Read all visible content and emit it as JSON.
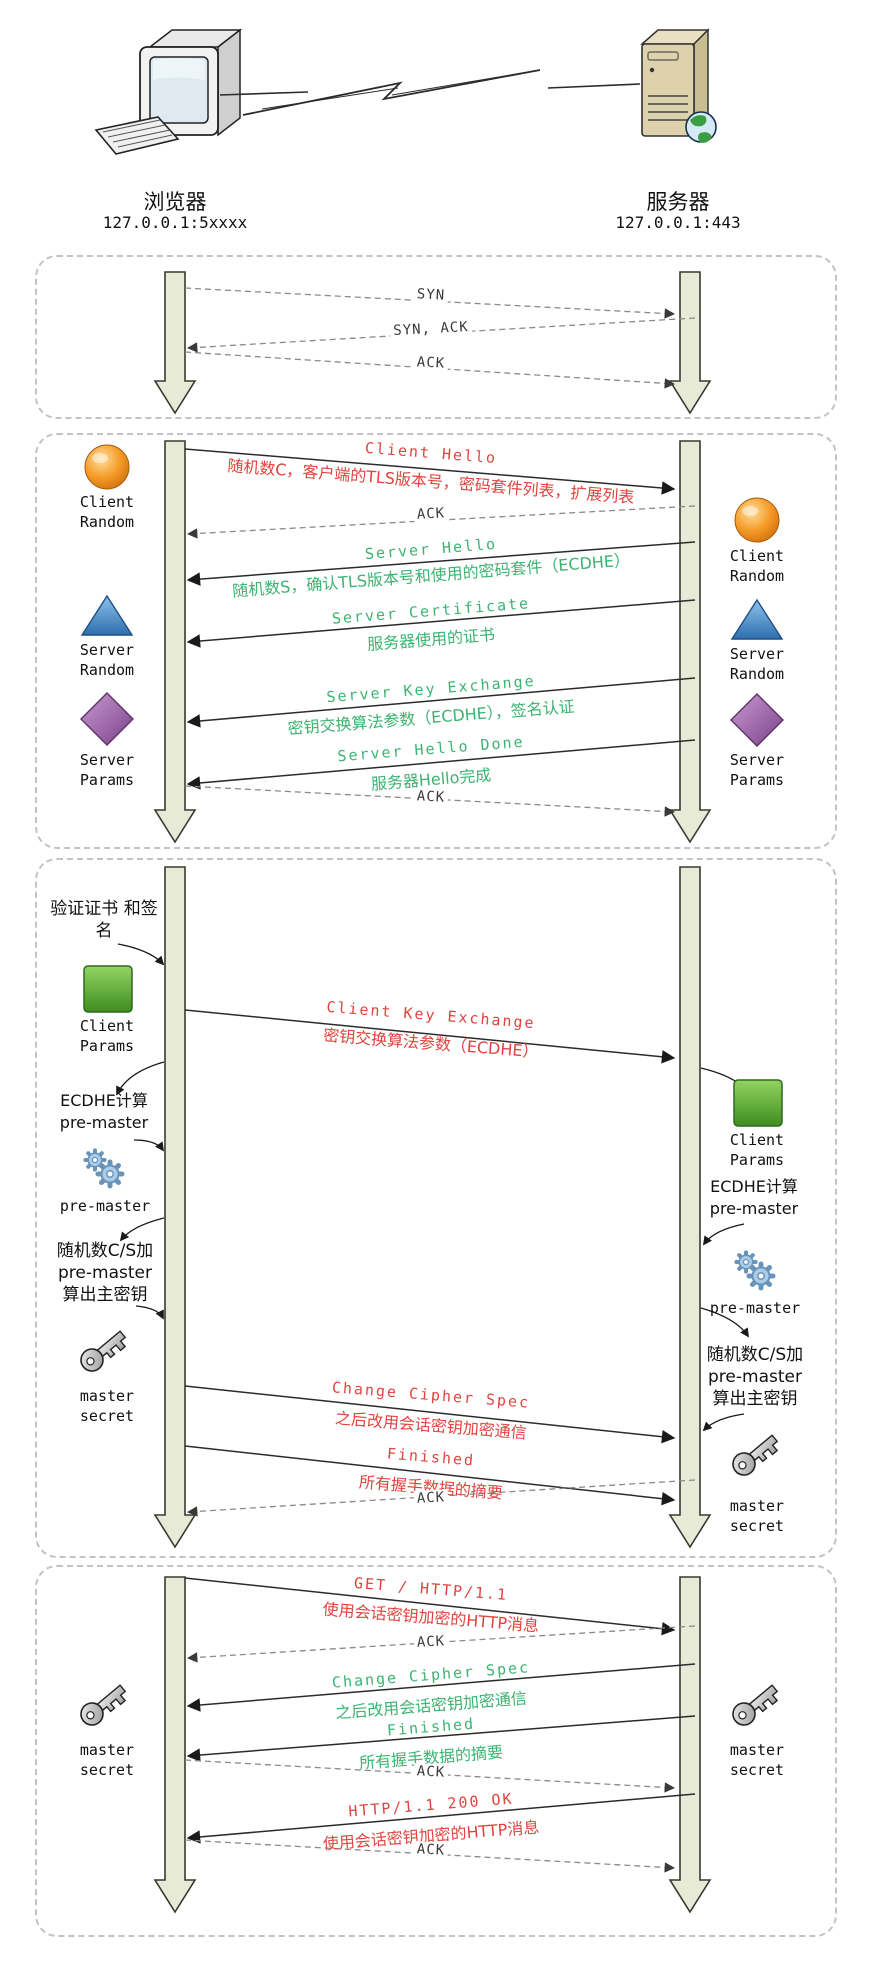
{
  "colors": {
    "message_red": "#e0443e",
    "message_green": "#3cb371",
    "lifeline_fill": "#e7ead6",
    "lifeline_border": "#3a3a30",
    "box_border": "#c3c3c3"
  },
  "endpoints": {
    "client": {
      "name": "浏览器",
      "address": "127.0.0.1:5xxxx",
      "icon": "computer-icon"
    },
    "server": {
      "name": "服务器",
      "address": "127.0.0.1:443",
      "icon": "server-icon"
    }
  },
  "phases": [
    {
      "id": "tcp-handshake",
      "messages": [
        {
          "title": "SYN",
          "direction": "right",
          "style": "dashed",
          "color": "black"
        },
        {
          "title": "SYN, ACK",
          "direction": "left",
          "style": "dashed",
          "color": "black"
        },
        {
          "title": "ACK",
          "direction": "right",
          "style": "dashed",
          "color": "black"
        }
      ]
    },
    {
      "id": "tls-hello",
      "messages": [
        {
          "title": "Client Hello",
          "subtitle": "随机数C，客户端的TLS版本号，密码套件列表，扩展列表",
          "direction": "right",
          "style": "solid",
          "color": "red"
        },
        {
          "title": "ACK",
          "direction": "left",
          "style": "dashed",
          "color": "black"
        },
        {
          "title": "Server Hello",
          "subtitle": "随机数S，确认TLS版本号和使用的密码套件（ECDHE）",
          "direction": "left",
          "style": "solid",
          "color": "green"
        },
        {
          "title": "Server Certificate",
          "subtitle": "服务器使用的证书",
          "direction": "left",
          "style": "solid",
          "color": "green"
        },
        {
          "title": "Server Key Exchange",
          "subtitle": "密钥交换算法参数（ECDHE），签名认证",
          "direction": "left",
          "style": "solid",
          "color": "green"
        },
        {
          "title": "Server Hello Done",
          "subtitle": "服务器Hello完成",
          "direction": "left",
          "style": "solid",
          "color": "green"
        },
        {
          "title": "ACK",
          "direction": "right",
          "style": "dashed",
          "color": "black"
        }
      ],
      "client_column": [
        {
          "icon": "sphere-icon",
          "label": "Client Random"
        },
        {
          "icon": "triangle-icon",
          "label": "Server Random"
        },
        {
          "icon": "diamond-icon",
          "label": "Server Params"
        }
      ],
      "server_column": [
        {
          "icon": "sphere-icon",
          "label": "Client Random"
        },
        {
          "icon": "triangle-icon",
          "label": "Server Random"
        },
        {
          "icon": "diamond-icon",
          "label": "Server Params"
        }
      ]
    },
    {
      "id": "key-exchange",
      "messages": [
        {
          "title": "Client Key Exchange",
          "subtitle": "密钥交换算法参数（ECDHE）",
          "direction": "right",
          "style": "solid",
          "color": "red"
        },
        {
          "title": "Change Cipher Spec",
          "subtitle": "之后改用会话密钥加密通信",
          "direction": "right",
          "style": "solid",
          "color": "red"
        },
        {
          "title": "Finished",
          "subtitle": "所有握手数据的摘要",
          "direction": "right",
          "style": "solid",
          "color": "red"
        },
        {
          "title": "ACK",
          "direction": "left",
          "style": "dashed",
          "color": "black"
        }
      ],
      "client_column": [
        {
          "note": "验证证书 和签名"
        },
        {
          "icon": "square-icon",
          "label": "Client Params"
        },
        {
          "note": "ECDHE计算 pre-master"
        },
        {
          "icon": "gears-icon",
          "label": "pre-master"
        },
        {
          "note": "随机数C/S加 pre-master 算出主密钥"
        },
        {
          "icon": "key-icon",
          "label": "master secret"
        }
      ],
      "server_column": [
        {
          "icon": "square-icon",
          "label": "Client Params"
        },
        {
          "note": "ECDHE计算 pre-master"
        },
        {
          "icon": "gears-icon",
          "label": "pre-master"
        },
        {
          "note": "随机数C/S加 pre-master 算出主密钥"
        },
        {
          "icon": "key-icon",
          "label": "master secret"
        }
      ]
    },
    {
      "id": "http-exchange",
      "messages": [
        {
          "title": "GET / HTTP/1.1",
          "subtitle": "使用会话密钥加密的HTTP消息",
          "direction": "right",
          "style": "solid",
          "color": "red"
        },
        {
          "title": "ACK",
          "direction": "left",
          "style": "dashed",
          "color": "black"
        },
        {
          "title": "Change Cipher Spec",
          "subtitle": "之后改用会话密钥加密通信",
          "direction": "left",
          "style": "solid",
          "color": "green"
        },
        {
          "title": "Finished",
          "subtitle": "所有握手数据的摘要",
          "direction": "left",
          "style": "solid",
          "color": "green"
        },
        {
          "title": "ACK",
          "direction": "right",
          "style": "dashed",
          "color": "black"
        },
        {
          "title": "HTTP/1.1 200 OK",
          "subtitle": "使用会话密钥加密的HTTP消息",
          "direction": "left",
          "style": "solid",
          "color": "red"
        },
        {
          "title": "ACK",
          "direction": "right",
          "style": "dashed",
          "color": "black"
        }
      ],
      "client_column": [
        {
          "icon": "key-icon",
          "label": "master secret"
        }
      ],
      "server_column": [
        {
          "icon": "key-icon",
          "label": "master secret"
        }
      ]
    }
  ]
}
